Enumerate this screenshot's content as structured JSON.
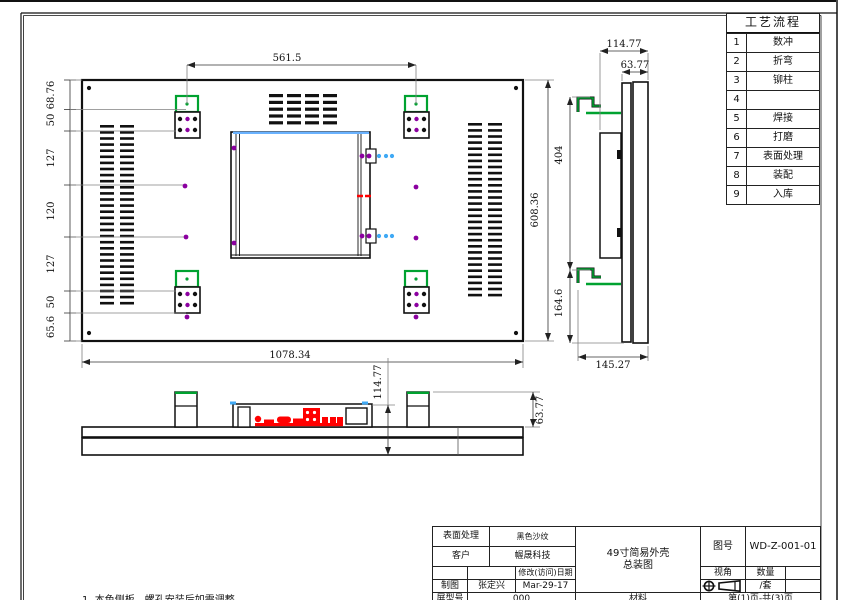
{
  "process_table": {
    "title": "工艺流程",
    "rows": [
      {
        "no": "1",
        "step": "数冲"
      },
      {
        "no": "2",
        "step": "折弯"
      },
      {
        "no": "3",
        "step": "铆柱"
      },
      {
        "no": "4",
        "step": ""
      },
      {
        "no": "5",
        "step": "焊接"
      },
      {
        "no": "6",
        "step": "打磨"
      },
      {
        "no": "7",
        "step": "表面处理"
      },
      {
        "no": "8",
        "step": "装配"
      },
      {
        "no": "9",
        "step": "入库"
      }
    ]
  },
  "title_block": {
    "surface_label": "表面处理",
    "surface_value": "黑色沙纹",
    "customer_label": "客户",
    "customer_value": "幄晟科技",
    "revision_label": "修改(访问)日期",
    "draft_label": "制图",
    "draft_name": "张定兴",
    "draft_date": "Mar-29-17",
    "model_label": "屏型号",
    "model_value": "000",
    "drawing_title": "49寸简易外壳\n总装图",
    "material_label": "材料",
    "drawing_no_label": "图号",
    "drawing_no": "WD-Z-001-01",
    "view_label": "视角",
    "qty_label": "数量",
    "qty_value": "/套",
    "page_info": "第(1)页-共(3)页"
  },
  "note": "1. 本色侧板，螺孔安装后如需调整",
  "dimensions": {
    "top_width": "561.5",
    "overall_width": "1078.34",
    "overall_height": "608.36",
    "left_chain": [
      "68.76",
      "50",
      "127",
      "120",
      "127",
      "50",
      "65.6"
    ],
    "side_depth": "114.77",
    "side_inner_depth": "63.77",
    "side_upper_span": "404",
    "side_lower_span": "164.6",
    "side_bottom_width": "145.27",
    "bottom_depth": "114.77",
    "bottom_bracket_depth": "63.77"
  },
  "colors": {
    "bracket_green": "#00A230",
    "hole_purple": "#8B00A0",
    "dot_blue": "#3FA9F5",
    "edge_blue": "#69B2FF",
    "mark_red": "#FF0000",
    "line_black": "#111111",
    "dim_gray": "#808080"
  },
  "drawing": {
    "vents": {
      "bar_w": 14,
      "bar_h": 2.6,
      "left_cols": [
        100,
        120
      ],
      "left_y": 125,
      "left_count": 30,
      "pitch": 6.1,
      "right_cols": [
        468,
        488
      ],
      "right_y": 123,
      "right_count": 29,
      "top_grid": {
        "cols": [
          269,
          287,
          305,
          323
        ],
        "y": 94,
        "rows": 5,
        "pitch": 6.8,
        "bar_h": 3.2
      }
    },
    "brackets": [
      {
        "x": 176,
        "y": 96,
        "extra_dot": false
      },
      {
        "x": 405,
        "y": 96,
        "extra_dot": false
      },
      {
        "x": 176,
        "y": 271,
        "extra_dot": true
      },
      {
        "x": 405,
        "y": 271,
        "extra_dot": true
      }
    ],
    "purple_dots": [
      [
        185,
        186
      ],
      [
        186,
        237
      ],
      [
        416,
        187
      ],
      [
        416,
        238
      ],
      [
        234,
        148
      ],
      [
        234,
        243
      ],
      [
        362,
        156
      ],
      [
        369,
        156
      ],
      [
        362,
        236
      ],
      [
        369,
        236
      ]
    ],
    "blue_dots": [
      [
        379,
        156
      ],
      [
        386,
        156
      ],
      [
        392,
        156
      ],
      [
        379,
        236
      ],
      [
        386,
        236
      ],
      [
        392,
        236
      ]
    ],
    "screw_dots": [
      [
        89,
        88
      ],
      [
        516,
        88
      ],
      [
        89,
        333
      ],
      [
        516,
        333
      ],
      [
        186,
        399
      ],
      [
        418,
        399
      ]
    ]
  }
}
